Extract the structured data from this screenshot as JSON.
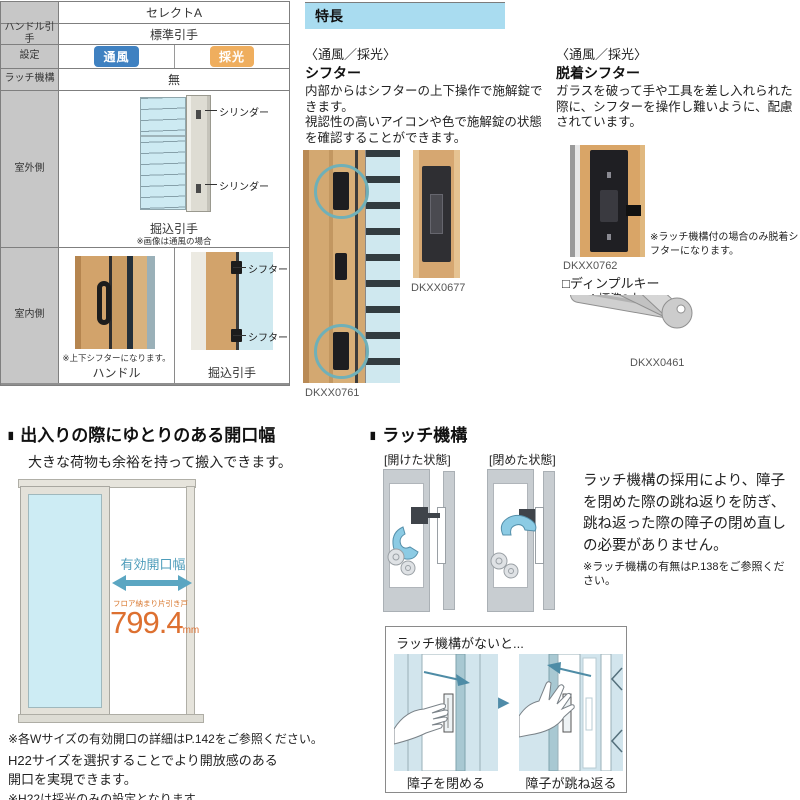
{
  "colors": {
    "badge_ventilation": "#3f81c1",
    "badge_daylight": "#efae5e",
    "feature_header_bg": "#a9dcf0",
    "accent_blue": "#4d9cba",
    "accent_orange": "#dd7030",
    "teal_circle": "#6fb0b8"
  },
  "spec_table": {
    "header": "セレクトA",
    "row_handle": {
      "label": "ハンドル引手",
      "value": "標準引手"
    },
    "row_setting": {
      "label": "設定",
      "badge_ventilation": "通風",
      "badge_daylight": "採光"
    },
    "row_latch": {
      "label": "ラッチ機構",
      "value": "無"
    },
    "row_outdoor": {
      "label": "室外側",
      "callout_top": "シリンダー",
      "callout_bottom": "シリンダー",
      "caption": "掘込引手",
      "note": "※画像は通風の場合"
    },
    "row_indoor": {
      "label": "室内側",
      "left_note": "※上下シフターになります。",
      "left_caption": "ハンドル",
      "callout_top": "シフター",
      "callout_bottom": "シフター",
      "right_caption": "掘込引手"
    }
  },
  "features": {
    "header": "特長",
    "shifter": {
      "category": "〈通風／採光〉",
      "title": "シフター",
      "body1": "内部からはシフターの上下操作で施解錠できます。",
      "body2": "視認性の高いアイコンや色で施解錠の状態を確認することができます。",
      "code_main": "DKXX0761",
      "code_detail": "DKXX0677"
    },
    "removable_shifter": {
      "category": "〈通風／採光〉",
      "title": "脱着シフター",
      "body": "ガラスを破って手や工具を差し入れられた際に、シフターを操作し難いように、配慮されています。",
      "code": "DKXX0762",
      "note": "※ラッチ機構付の場合のみ脱着シフターになります。",
      "key_title": "□ディンプルキー",
      "key_note": "※標準3本",
      "key_code": "DKXX0461"
    }
  },
  "opening_section": {
    "bullet": "■",
    "heading": "出入りの際にゆとりのある開口幅",
    "subheading": "大きな荷物も余裕を持って搬入できます。",
    "diagram": {
      "width_label": "有効開口幅",
      "door_type": "フロア納まり片引き戸",
      "value": "799.4",
      "unit": "mm"
    },
    "note1": "※各Wサイズの有効開口の詳細はP.142をご参照ください。",
    "note2": "H22サイズを選択することでより開放感のある",
    "note3": "開口を実現できます。",
    "note4": "※H22は採光のみの設定となります。"
  },
  "latch_section": {
    "bullet": "■",
    "heading": "ラッチ機構",
    "state_open": "[開けた状態]",
    "state_closed": "[閉めた状態]",
    "body": "ラッチ機構の採用により、障子を閉めた際の跳ね返りを防ぎ、跳ね返った際の障子の閉め直しの必要がありません。",
    "note": "※ラッチ機構の有無はP.138をご参照ください。",
    "no_latch_box": {
      "title": "ラッチ機構がないと...",
      "arrow": "▶",
      "caption_close": "障子を閉める",
      "caption_bounce": "障子が跳ね返る"
    }
  }
}
